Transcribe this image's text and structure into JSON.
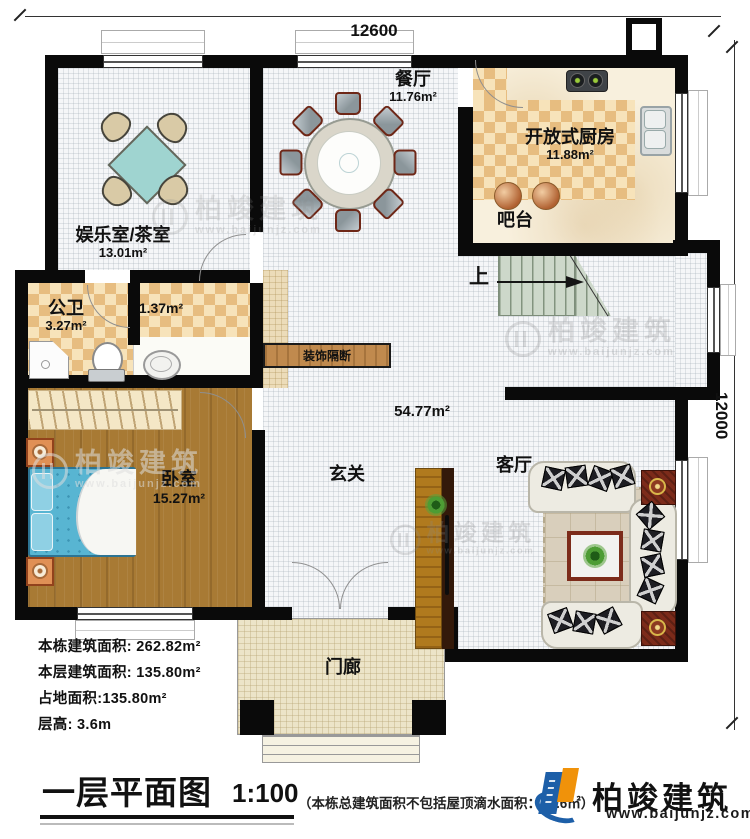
{
  "dims": {
    "top": "12600",
    "right": "12000"
  },
  "rooms": {
    "tea": {
      "name": "娱乐室/茶室",
      "area": "13.01m²"
    },
    "dining": {
      "name": "餐厅",
      "area": "11.76m²"
    },
    "kitchen": {
      "name": "开放式厨房",
      "area": "11.88m²"
    },
    "bar": {
      "name": "吧台"
    },
    "bath": {
      "name": "公卫",
      "area": "3.27m²"
    },
    "bath2": {
      "area": "1.37m²"
    },
    "bedroom": {
      "name": "卧室",
      "area": "15.27m²"
    },
    "foyer": {
      "name": "玄关"
    },
    "living": {
      "name": "客厅"
    },
    "hall": {
      "area": "54.77m²"
    },
    "porch": {
      "name": "门廊"
    },
    "partition": {
      "name": "装饰隔断"
    },
    "stairs": {
      "up": "上"
    }
  },
  "stats": {
    "line1": "本栋建筑面积: 262.82m²",
    "line2": "本层建筑面积: 135.80m²",
    "line3": "占地面积:135.80m²",
    "line4": "层高: 3.6m"
  },
  "footer": {
    "title": "一层平面图",
    "scale": "1:100",
    "note": "（本栋总建筑面积不包括屋顶滴水面积：15.6㎡）",
    "brand": "柏竣建筑",
    "site": "www.baijunjz.com"
  },
  "watermark": {
    "brand": "柏竣建筑",
    "site": "www.baijunjz.com"
  },
  "colors": {
    "wall": "#0a0a0a",
    "checker": "#e7bd80",
    "marble": "#f8f0dd",
    "wood": "#a87a34",
    "partition_wood": "#c08a4e",
    "stair": "#cdd8ca",
    "table_teal": "#9fd4d0",
    "logo_blue": "#1d5fa8",
    "logo_orange": "#f0920a"
  }
}
